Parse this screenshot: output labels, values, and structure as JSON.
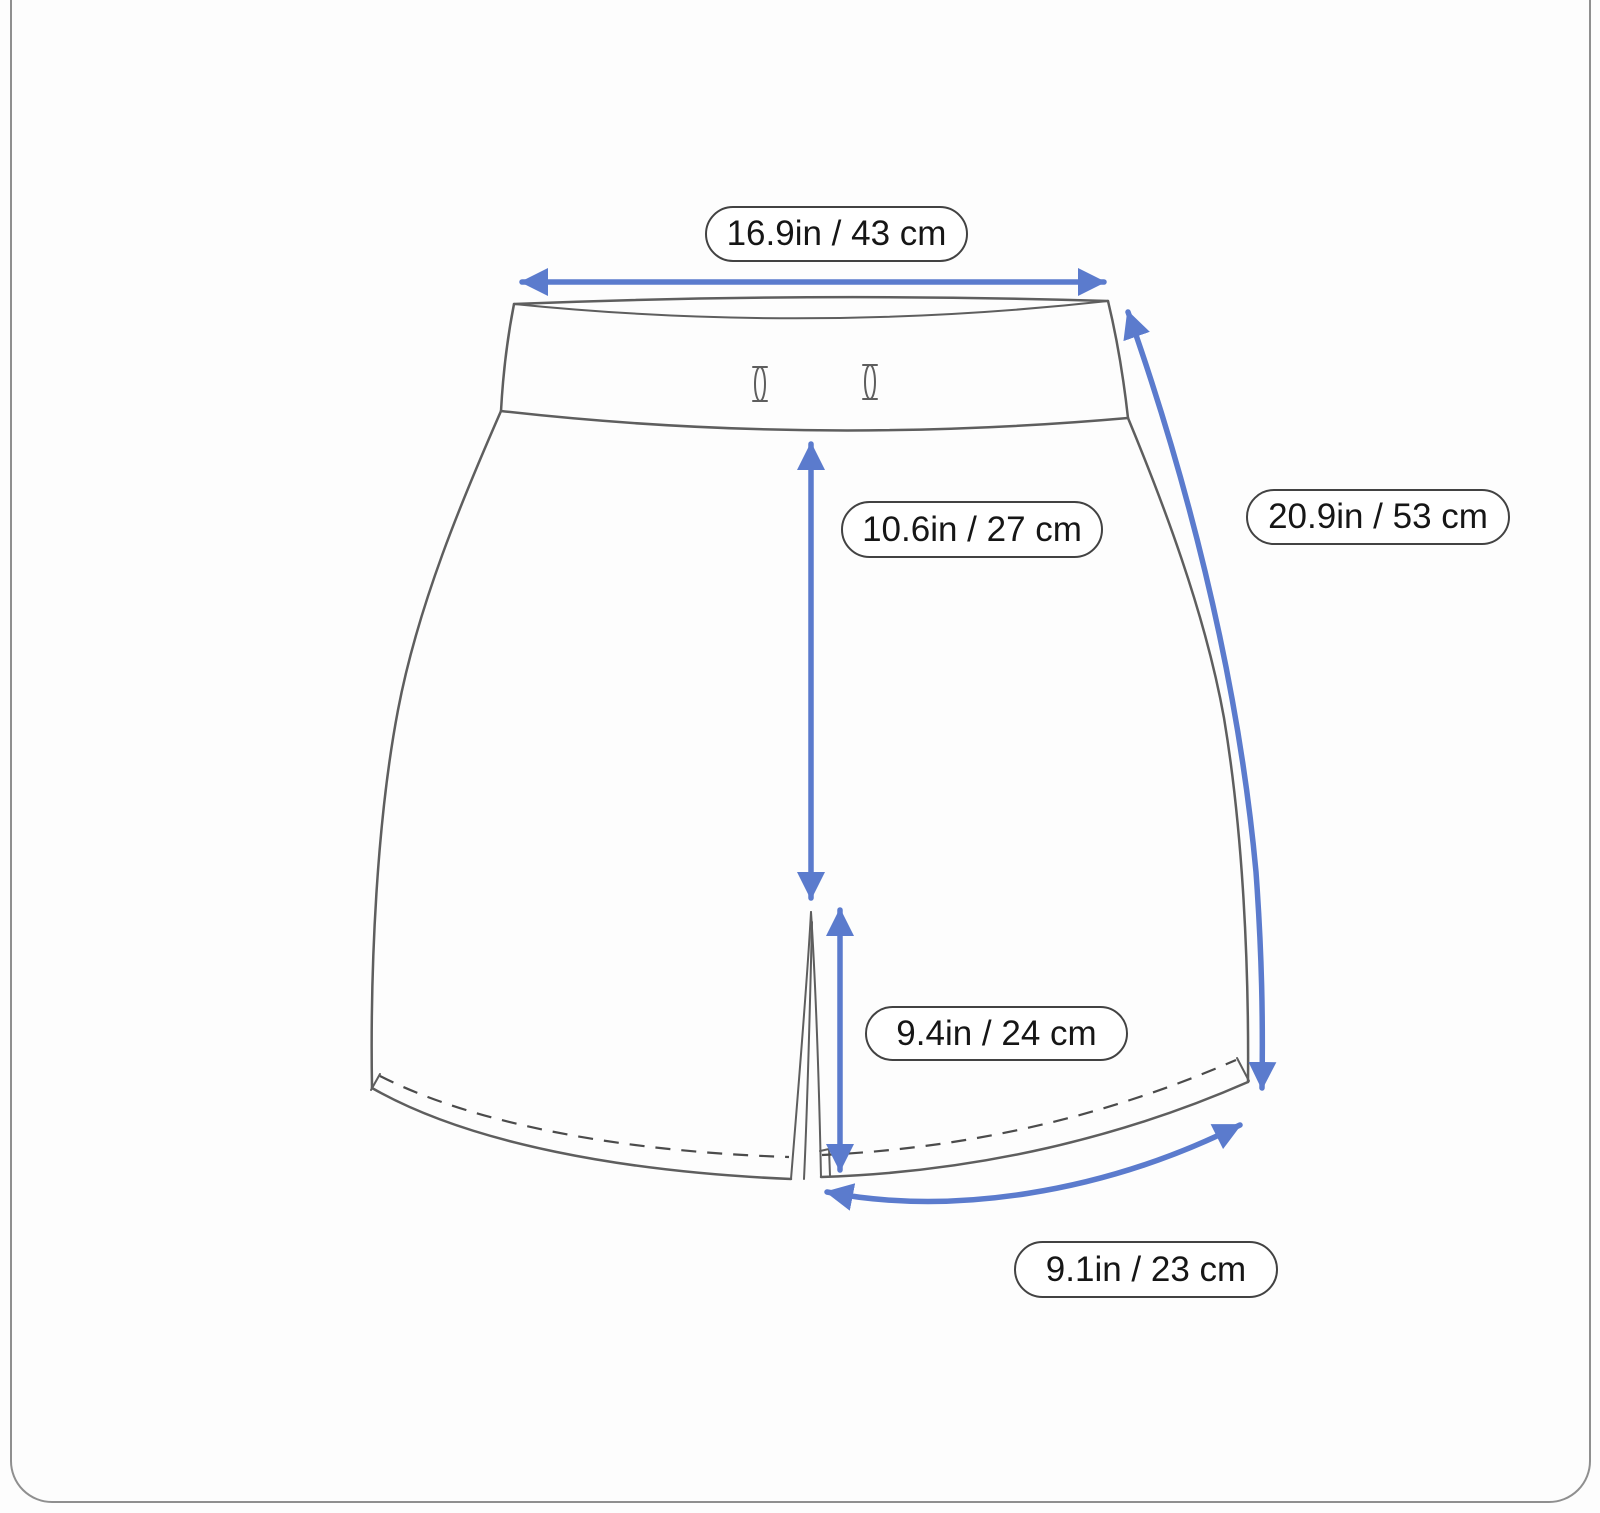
{
  "diagram": {
    "subject": "shorts measurement size chart",
    "measurements": [
      {
        "id": "waist-width",
        "label": "16.9in / 43 cm"
      },
      {
        "id": "side-length",
        "label": "20.9in / 53 cm"
      },
      {
        "id": "front-rise",
        "label": "10.6in / 27 cm"
      },
      {
        "id": "slit-height",
        "label": "9.4in / 24 cm"
      },
      {
        "id": "leg-opening",
        "label": "9.1in / 23 cm"
      }
    ],
    "colors": {
      "arrow": "#5b7bcd",
      "outline": "#5e5e5e",
      "stitch": "#4b4b4b",
      "label_border": "#424242",
      "label_bg": "#ffffff",
      "text": "#161616",
      "page_border": "#8f8f8f",
      "background": "#fdfdfd"
    }
  }
}
